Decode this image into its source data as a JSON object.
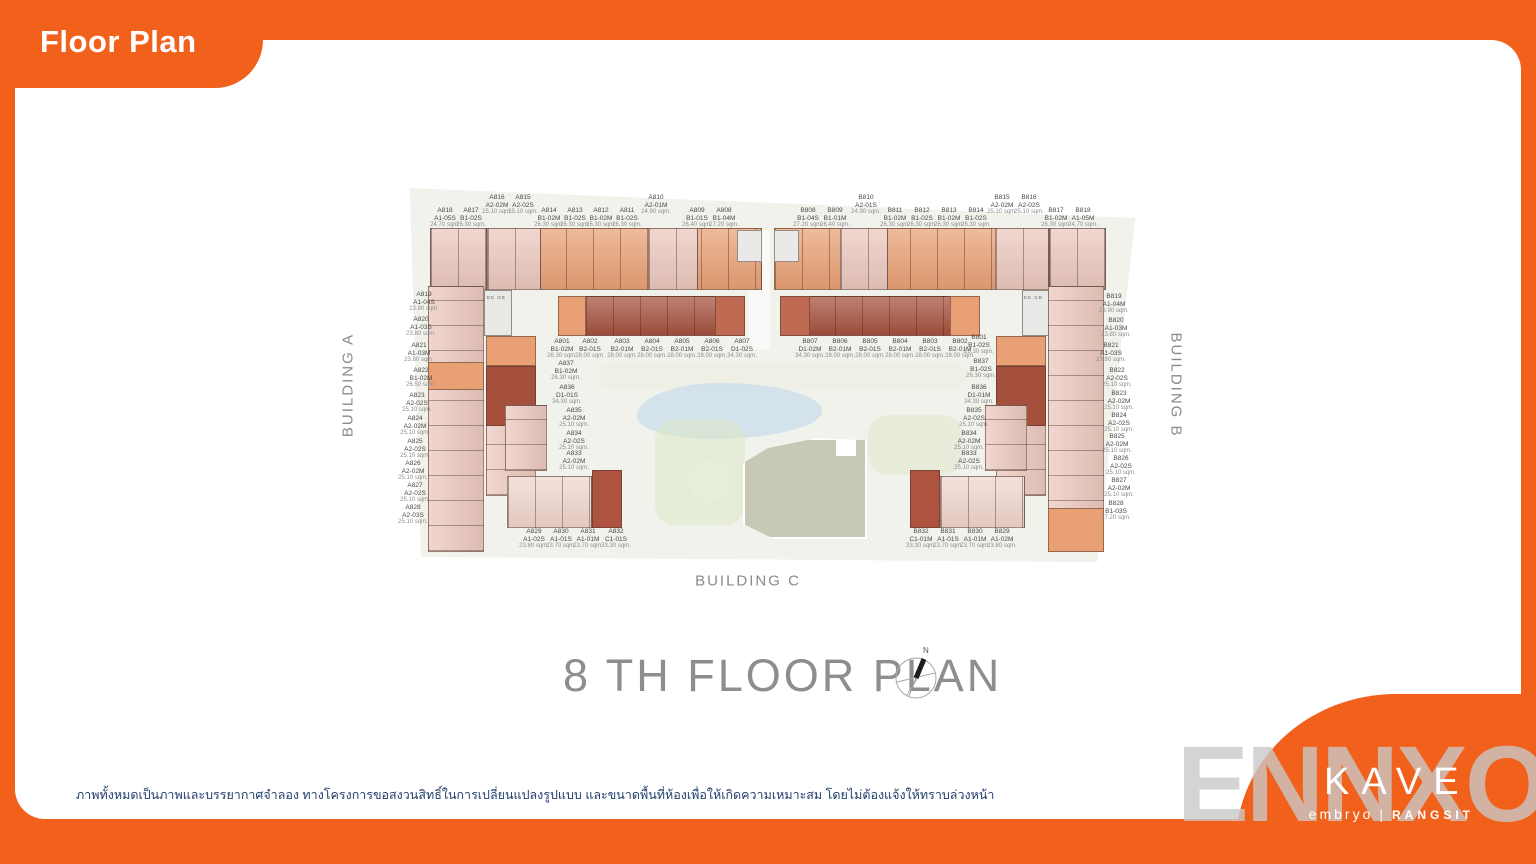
{
  "slide": {
    "title": "Floor Plan",
    "floor_title": "8 TH FLOOR PLAN",
    "compass_label": "N",
    "watermark": "ENNXO",
    "disclaimer": "ภาพทั้งหมดเป็นภาพและบรรยากาศจำลอง ทางโครงการขอสงวนสิทธิ์ในการเปลี่ยนแปลงรูปแบบ และขนาดพื้นที่ห้องเพื่อให้เกิดความเหมาะสม โดยไม่ต้องแจ้งให้ทราบล่วงหน้า"
  },
  "logo": {
    "brand": "KAVE",
    "sub_left": "embryo",
    "sub_divider": "|",
    "sub_right": "RANGSIT"
  },
  "buildings": {
    "a_label": "BUILDING A",
    "b_label": "BUILDING B",
    "c_label": "BUILDING C"
  },
  "core_labels": [
    "EE",
    "GB"
  ],
  "colors": {
    "accent_orange": "#F2611C",
    "site": "#f2f2ed",
    "plan_salmon": "#e9a074",
    "plan_pink": "#ebc7bd",
    "plan_light_pink": "#f0d5cd",
    "plan_dark": "#a5503d",
    "plan_dark2": "#ae5340",
    "plan_medium": "#bf6a52",
    "core": "#e9e9e7",
    "pool": "#cfe0ea",
    "green": "#dce8c8",
    "roof": "#c8c8b6",
    "disclaimer_navy": "#24406e",
    "title_gray": "#8e8e8e",
    "watermark_gray": "#c9c9c9"
  },
  "units": {
    "building_a": {
      "top_row": [
        {
          "id": "A818",
          "type": "A1-05S",
          "area": "24.70 sqm."
        },
        {
          "id": "A817",
          "type": "B1-02S",
          "area": "26.30 sqm."
        },
        {
          "id": "A816",
          "type": "A2-02M",
          "area": "25.10 sqm."
        },
        {
          "id": "A815",
          "type": "A2-02S",
          "area": "25.10 sqm."
        },
        {
          "id": "A814",
          "type": "B1-02M",
          "area": "26.30 sqm."
        },
        {
          "id": "A813",
          "type": "B1-02S",
          "area": "26.30 sqm."
        },
        {
          "id": "A812",
          "type": "B1-02M",
          "area": "26.30 sqm."
        },
        {
          "id": "A811",
          "type": "B1-02S",
          "area": "26.30 sqm."
        },
        {
          "id": "A810",
          "type": "A2-01M",
          "area": "24.90 sqm."
        },
        {
          "id": "A809",
          "type": "B1-01S",
          "area": "26.40 sqm."
        },
        {
          "id": "A808",
          "type": "B1-04M",
          "area": "27.20 sqm."
        }
      ],
      "left_col": [
        {
          "id": "A819",
          "type": "A1-04S",
          "area": "23.90 sqm."
        },
        {
          "id": "A820",
          "type": "A1-03S",
          "area": "23.80 sqm."
        },
        {
          "id": "A821",
          "type": "A1-03M",
          "area": "23.80 sqm."
        },
        {
          "id": "A822",
          "type": "B1-02M",
          "area": "26.50 sqm."
        },
        {
          "id": "A823",
          "type": "A2-02S",
          "area": "25.10 sqm."
        },
        {
          "id": "A824",
          "type": "A2-02M",
          "area": "25.10 sqm."
        },
        {
          "id": "A825",
          "type": "A2-02S",
          "area": "25.10 sqm."
        },
        {
          "id": "A826",
          "type": "A2-02M",
          "area": "25.10 sqm."
        },
        {
          "id": "A827",
          "type": "A2-02S",
          "area": "25.10 sqm."
        },
        {
          "id": "A828",
          "type": "A2-03S",
          "area": "25.10 sqm."
        }
      ],
      "mid_row": [
        {
          "id": "A802",
          "type": "B2-01S",
          "area": "28.00 sqm."
        },
        {
          "id": "A803",
          "type": "B2-01M",
          "area": "28.00 sqm."
        },
        {
          "id": "A804",
          "type": "B2-01S",
          "area": "28.00 sqm."
        },
        {
          "id": "A805",
          "type": "B2-01M",
          "area": "28.00 sqm."
        },
        {
          "id": "A806",
          "type": "B2-01S",
          "area": "28.00 sqm."
        },
        {
          "id": "A807",
          "type": "D1-02S",
          "area": "34.30 sqm."
        }
      ],
      "stack": [
        {
          "id": "A801",
          "type": "B1-02M",
          "area": "26.30 sqm."
        },
        {
          "id": "A837",
          "type": "B1-02M",
          "area": "26.30 sqm."
        },
        {
          "id": "A836",
          "type": "D1-01S",
          "area": "34.30 sqm."
        },
        {
          "id": "A835",
          "type": "A2-02M",
          "area": "25.10 sqm."
        },
        {
          "id": "A834",
          "type": "A2-02S",
          "area": "25.10 sqm."
        },
        {
          "id": "A833",
          "type": "A2-02M",
          "area": "25.10 sqm."
        }
      ],
      "bottom_row": [
        {
          "id": "A829",
          "type": "A1-02S",
          "area": "23.80 sqm."
        },
        {
          "id": "A830",
          "type": "A1-01S",
          "area": "23.70 sqm."
        },
        {
          "id": "A831",
          "type": "A1-01M",
          "area": "23.70 sqm."
        },
        {
          "id": "A832",
          "type": "C1-01S",
          "area": "33.30 sqm."
        }
      ]
    },
    "building_b": {
      "top_row": [
        {
          "id": "B808",
          "type": "B1-04S",
          "area": "27.20 sqm."
        },
        {
          "id": "B809",
          "type": "B1-01M",
          "area": "26.40 sqm."
        },
        {
          "id": "B810",
          "type": "A2-01S",
          "area": "24.90 sqm."
        },
        {
          "id": "B811",
          "type": "B1-02M",
          "area": "26.30 sqm."
        },
        {
          "id": "B812",
          "type": "B1-02S",
          "area": "26.30 sqm."
        },
        {
          "id": "B813",
          "type": "B1-02M",
          "area": "26.30 sqm."
        },
        {
          "id": "B814",
          "type": "B1-02S",
          "area": "26.30 sqm."
        },
        {
          "id": "B815",
          "type": "A2-02M",
          "area": "25.10 sqm."
        },
        {
          "id": "B816",
          "type": "A2-02S",
          "area": "25.10 sqm."
        },
        {
          "id": "B817",
          "type": "B1-02M",
          "area": "26.30 sqm."
        },
        {
          "id": "B818",
          "type": "A1-05M",
          "area": "24.70 sqm."
        }
      ],
      "right_col": [
        {
          "id": "B819",
          "type": "A1-04M",
          "area": "23.90 sqm."
        },
        {
          "id": "B820",
          "type": "A1-03M",
          "area": "23.80 sqm."
        },
        {
          "id": "B821",
          "type": "A1-03S",
          "area": "23.80 sqm."
        },
        {
          "id": "B822",
          "type": "A2-02S",
          "area": "25.10 sqm."
        },
        {
          "id": "B823",
          "type": "A2-02M",
          "area": "25.10 sqm."
        },
        {
          "id": "B824",
          "type": "A2-02S",
          "area": "25.10 sqm."
        },
        {
          "id": "B825",
          "type": "A2-02M",
          "area": "25.10 sqm."
        },
        {
          "id": "B826",
          "type": "A2-02S",
          "area": "25.10 sqm."
        },
        {
          "id": "B827",
          "type": "A2-02M",
          "area": "25.10 sqm."
        },
        {
          "id": "B828",
          "type": "B1-03S",
          "area": "27.20 sqm."
        }
      ],
      "mid_row": [
        {
          "id": "B807",
          "type": "D1-02M",
          "area": "34.30 sqm."
        },
        {
          "id": "B806",
          "type": "B2-01M",
          "area": "28.00 sqm."
        },
        {
          "id": "B805",
          "type": "B2-01S",
          "area": "28.00 sqm."
        },
        {
          "id": "B804",
          "type": "B2-01M",
          "area": "28.00 sqm."
        },
        {
          "id": "B803",
          "type": "B2-01S",
          "area": "28.00 sqm."
        },
        {
          "id": "B802",
          "type": "B2-01M",
          "area": "28.00 sqm."
        }
      ],
      "stack": [
        {
          "id": "B801",
          "type": "B1-02S",
          "area": "26.30 sqm."
        },
        {
          "id": "B837",
          "type": "B1-02S",
          "area": "26.30 sqm."
        },
        {
          "id": "B836",
          "type": "D1-01M",
          "area": "34.30 sqm."
        },
        {
          "id": "B835",
          "type": "A2-02S",
          "area": "25.10 sqm."
        },
        {
          "id": "B834",
          "type": "A2-02M",
          "area": "25.10 sqm."
        },
        {
          "id": "B833",
          "type": "A2-02S",
          "area": "25.10 sqm."
        }
      ],
      "bottom_row": [
        {
          "id": "B832",
          "type": "C1-01M",
          "area": "33.30 sqm."
        },
        {
          "id": "B831",
          "type": "A1-01S",
          "area": "23.70 sqm."
        },
        {
          "id": "B830",
          "type": "A1-01M",
          "area": "23.70 sqm."
        },
        {
          "id": "B829",
          "type": "A1-02M",
          "area": "23.80 sqm."
        }
      ]
    }
  }
}
